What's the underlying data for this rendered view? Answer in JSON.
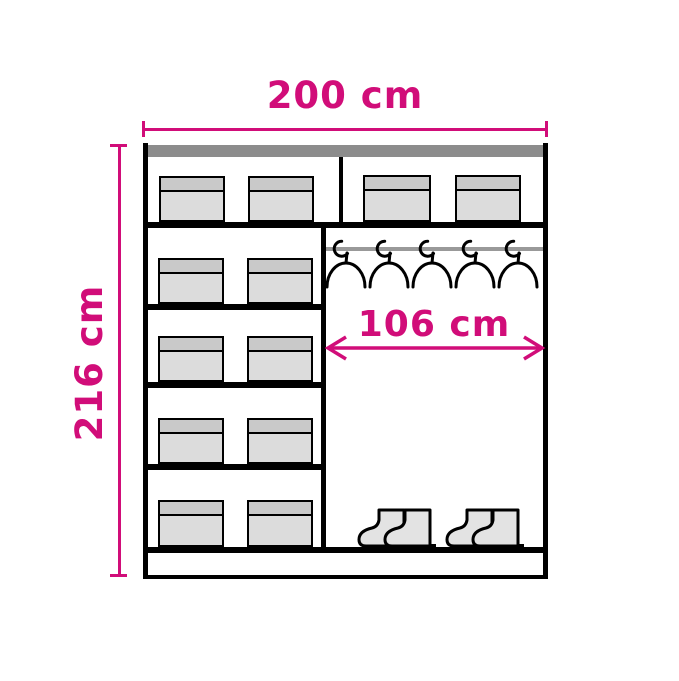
{
  "page": {
    "type": "furniture-dimension-diagram",
    "subject": "wardrobe interior layout with shelves, storage boxes, hanging rail and shoes"
  },
  "labels": {
    "width": "200 cm",
    "height": "216 cm",
    "interior_width": "106 cm"
  },
  "colors": {
    "page_bg": "#ffffff",
    "accent": "#d10d79",
    "outline": "#000000",
    "panel_top": "#8c8c8c",
    "rail": "#999999",
    "box_body": "#dcdcdc",
    "box_lid": "#c9c9c9",
    "boot": "#e3e3e3"
  },
  "contents": {
    "hanger_count": 5,
    "boot_pairs": 2,
    "storage_boxes": 12,
    "left_shelf_levels": 5
  }
}
